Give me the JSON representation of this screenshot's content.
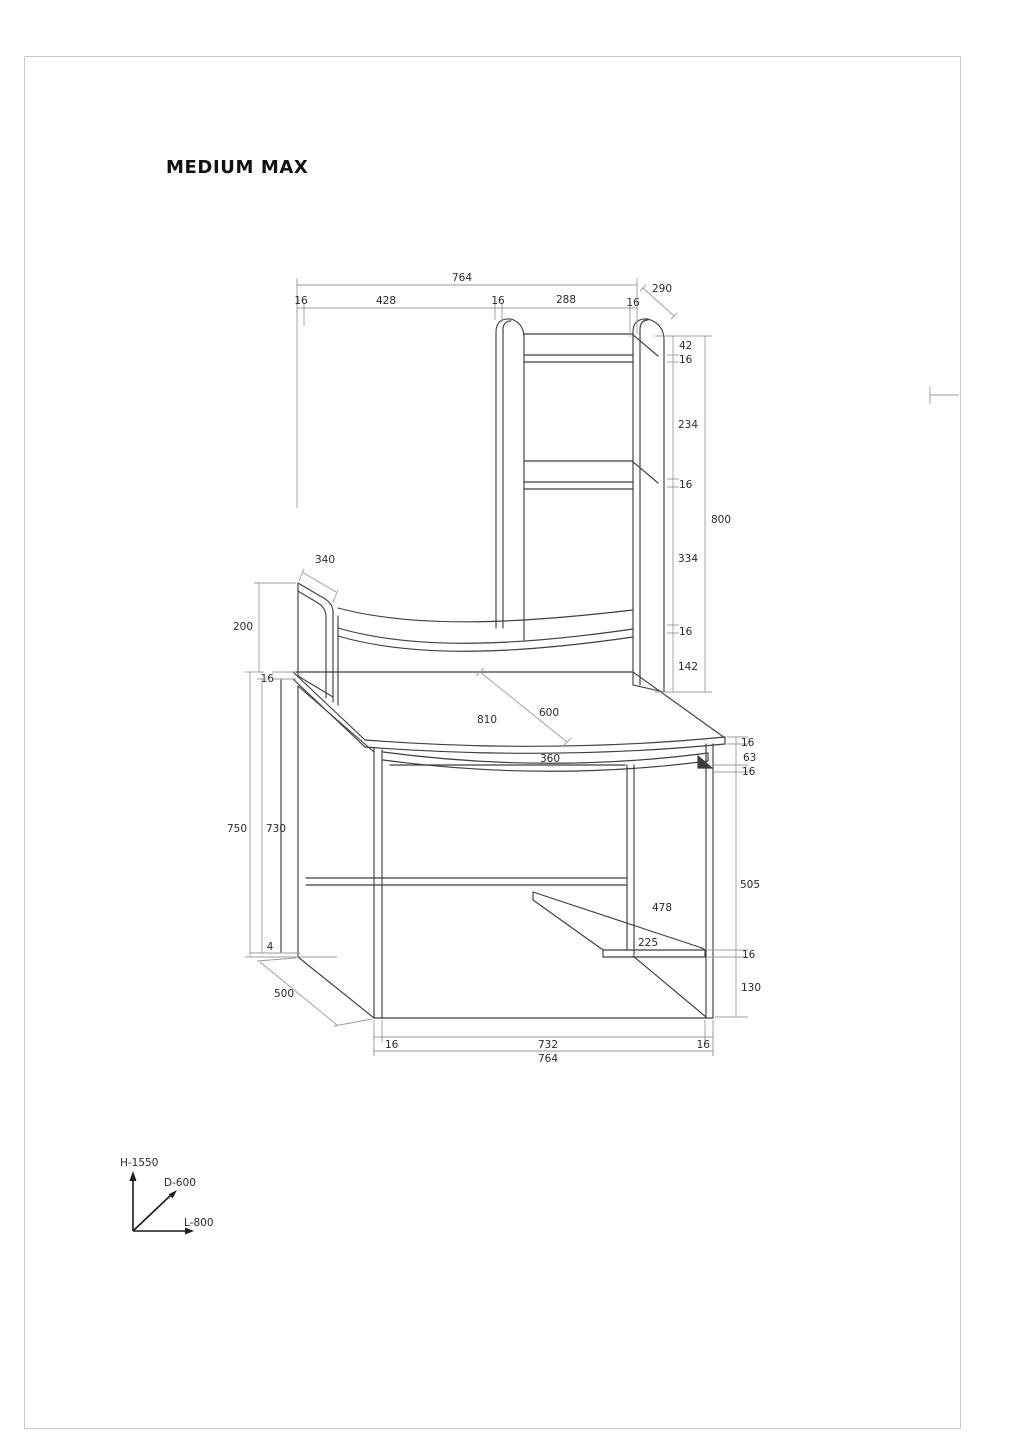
{
  "title": "MEDIUM MAX",
  "dims": {
    "top": {
      "total": "764",
      "t1": "16",
      "t2": "428",
      "t3": "16",
      "t4": "288",
      "t5": "16",
      "depth": "290"
    },
    "right_upper": {
      "a1": "42",
      "a2": "16",
      "a3": "234",
      "a4": "16",
      "a5": "334",
      "a6": "16",
      "a7": "142",
      "total": "800"
    },
    "left_panel": {
      "depth": "340",
      "height": "200",
      "thickness": "16"
    },
    "left_lower": {
      "outer": "750",
      "inner": "730",
      "base": "4",
      "side_depth": "500"
    },
    "desk": {
      "width": "810",
      "depth": "600",
      "tray": "360"
    },
    "right_lower": {
      "b1": "16",
      "b2": "63",
      "b3": "16",
      "b4": "505",
      "b5": "16",
      "b6": "130"
    },
    "shelf": {
      "depth": "478",
      "width": "225"
    },
    "bottom": {
      "left": "16",
      "middle": "732",
      "right": "16",
      "total": "764"
    }
  },
  "axes": {
    "height": "H-1550",
    "depth": "D-600",
    "length": "L-800"
  },
  "colors": {
    "line": "#3f3f3f",
    "dim": "#9b9b9b",
    "text": "#2a2a2a",
    "border": "#c9c9c9"
  }
}
